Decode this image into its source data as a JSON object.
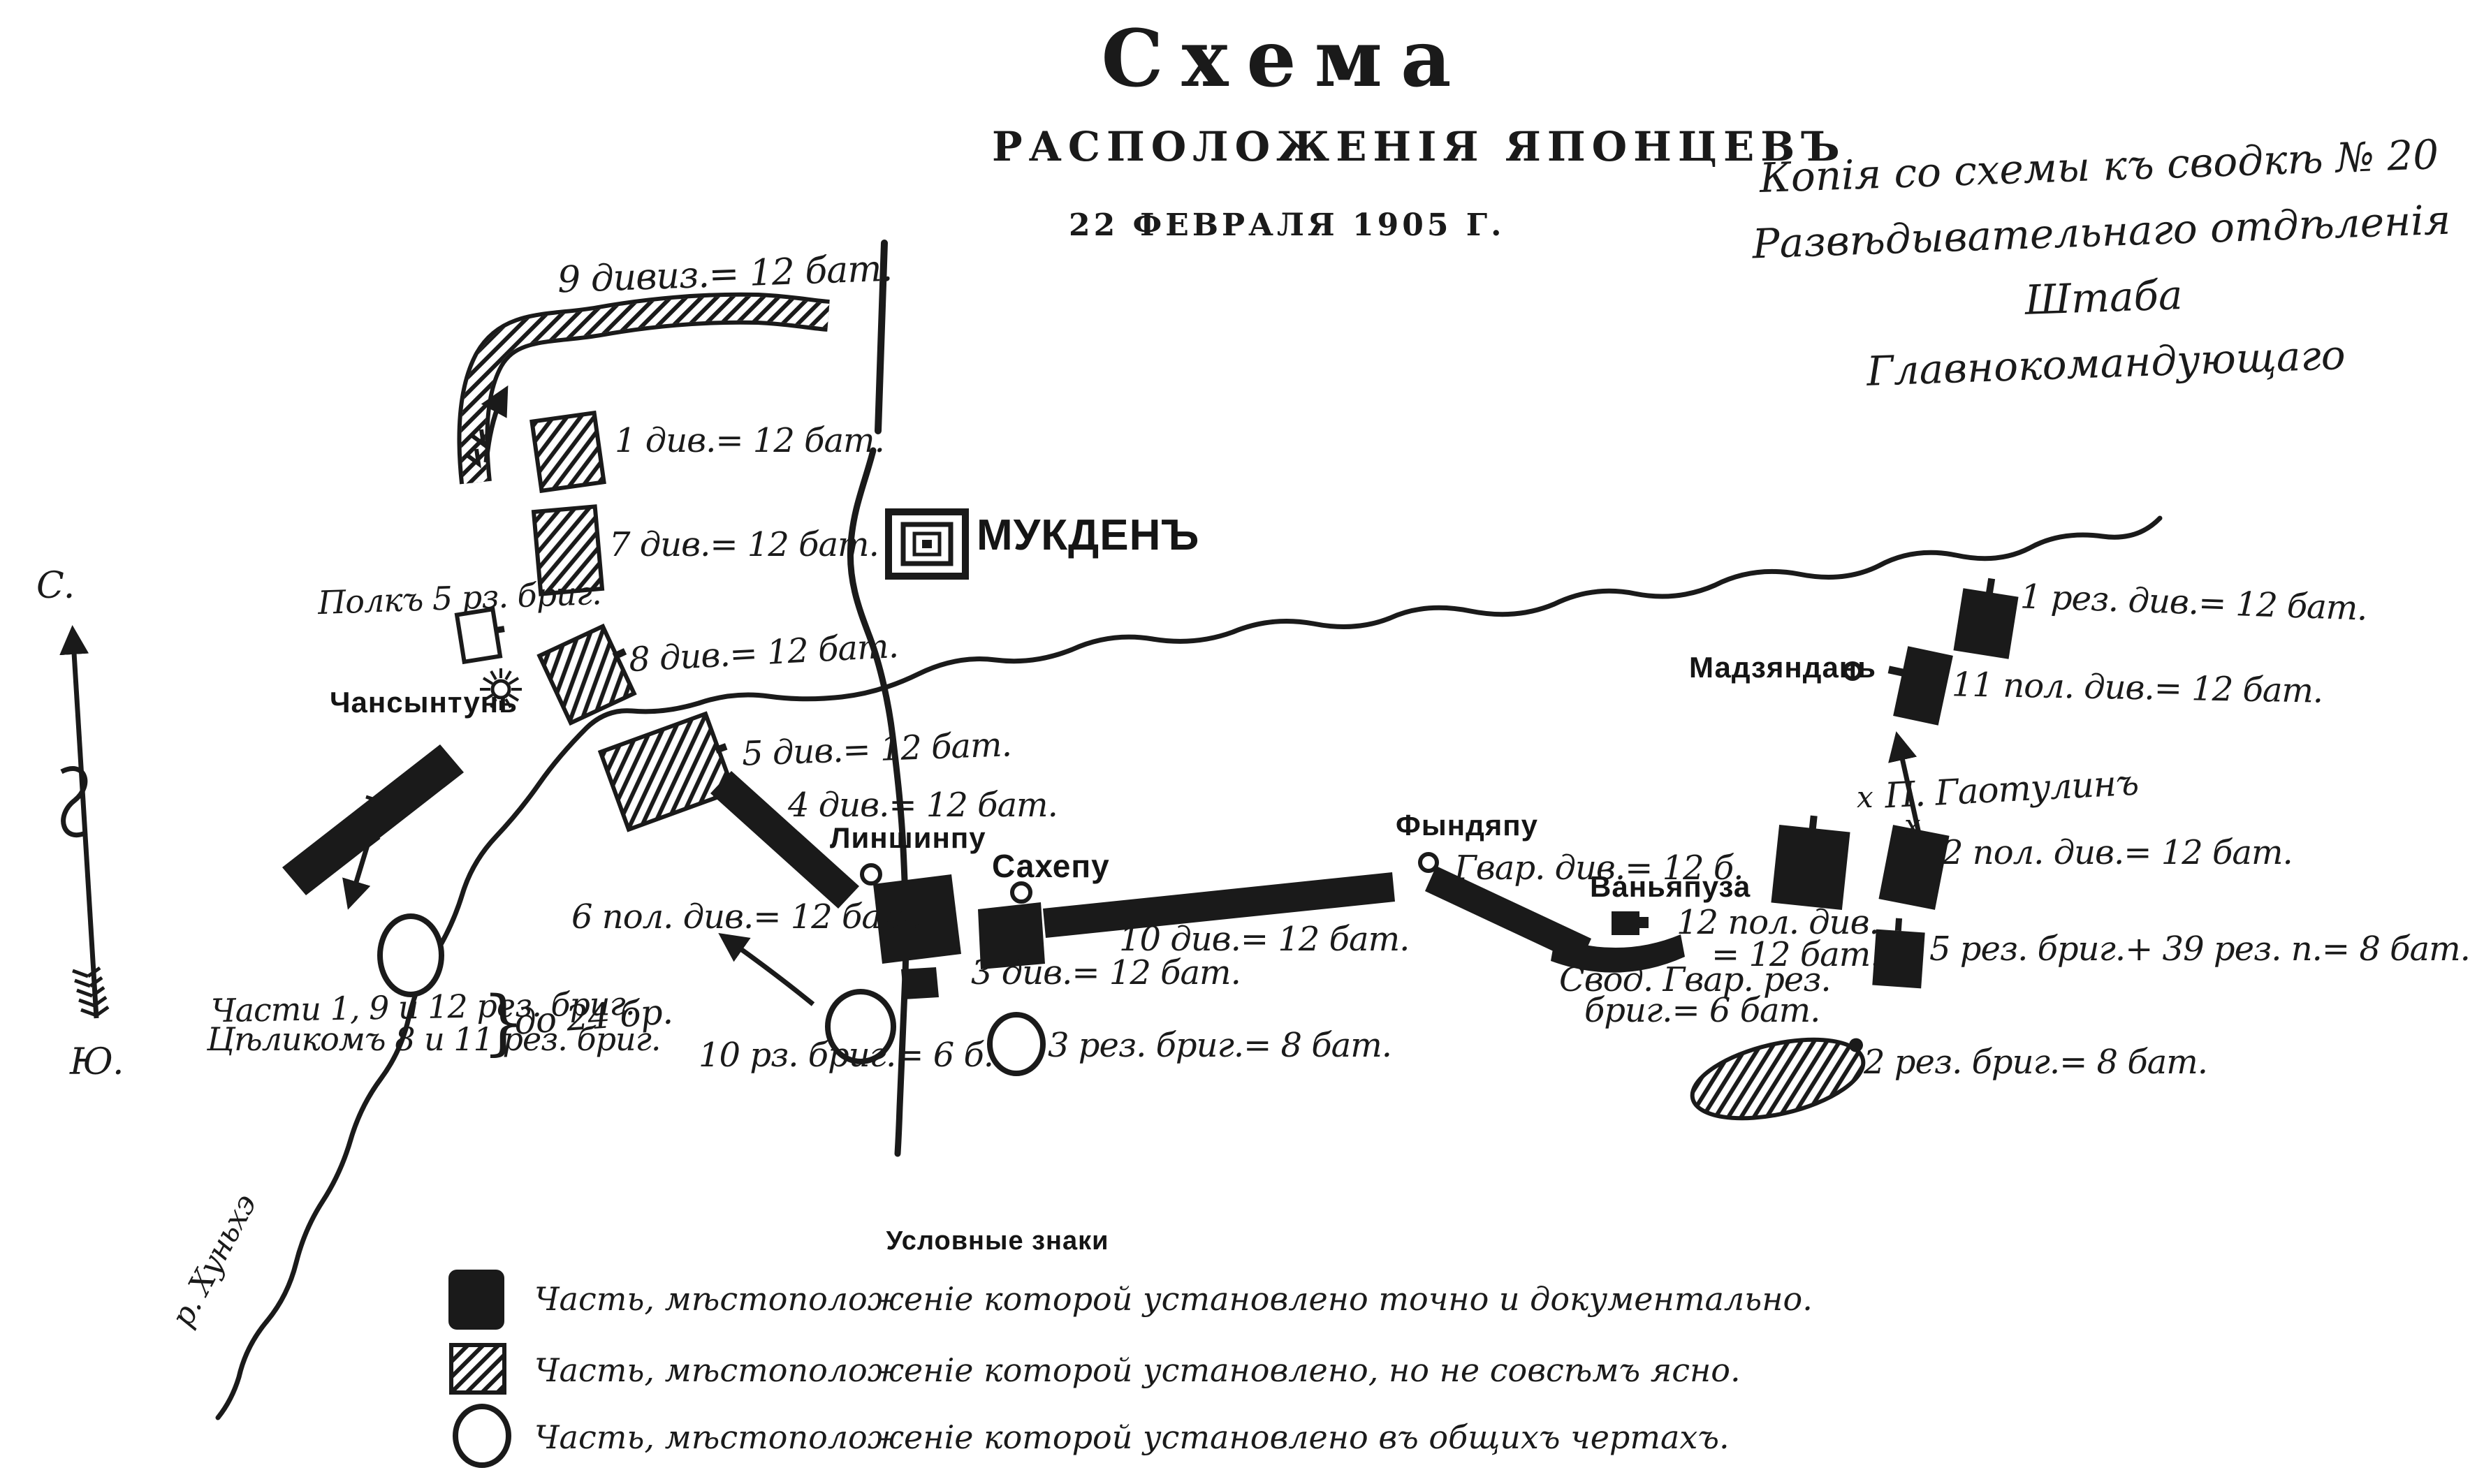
{
  "title": {
    "main": "Схема",
    "sub": "РАСПОЛОЖЕНІЯ ЯПОНЦЕВЪ",
    "date": "22 ФЕВРАЛЯ 1905 Г."
  },
  "note": {
    "line1": "Копія со схемы къ сводкѣ № 20",
    "line2": "Развѣдывательнаго отдѣленія Штаба",
    "line3": "Главнокомандующаго"
  },
  "compass": {
    "north": "С.",
    "south": "Ю."
  },
  "towns": {
    "mukden": "МУКДЕНЪ",
    "chansyntun": "Чансынтунь",
    "linshinpu": "Линшинпу",
    "sahepu": "Сахепу",
    "fyndyapu": "Фындяпу",
    "vanyapuza": "Ваньяпуза",
    "madzyandan": "Мадзяндань",
    "gaotulin": "П. Гаотулинъ",
    "gaotulin_mark": "х",
    "river": "р. Хуньхэ"
  },
  "units": {
    "div9": "9 дивиз.= 12 бат.",
    "div1": "1 див.= 12 бат.",
    "div7": "7 див.= 12 бат.",
    "polk5": "Полкъ 5 рз. бриг.",
    "div8": "8 див.= 12 бат.",
    "div5": "5 див.= 12 бат.",
    "div4": "4 див.= 12 бат.",
    "pol6": "6 пол. див.= 12 бат.",
    "div3": "3 див.= 12 бат.",
    "div10": "10 див.= 12 бат.",
    "gvar": "Гвар. див.= 12 б.",
    "chasti_line1": "Части 1, 9 и 12 рез. бриг.",
    "chasti_line2": "Цѣликомъ 8 и 11 рез. бриг.",
    "brace": "}",
    "do24": "до 24 бр.",
    "rz10": "10 рз. бриг.= 6 б.",
    "rez3": "3 рез. бриг.= 8 бат.",
    "svod_line1": "Свод. Гвар. рез.",
    "svod_line2": "бриг.= 6 бат.",
    "pol12_line1": "12 пол. див.",
    "pol12_line2": "= 12 бат.",
    "pol2": "2 пол. див.= 12 бат.",
    "rez1": "1 рез. див.= 12 бат.",
    "pol11": "11 пол. див.= 12 бат.",
    "rez5": "5 рез. бриг.+ 39 рез. п.= 8 бат.",
    "rez2": "2 рез. бриг.= 8 бат."
  },
  "legend": {
    "header": "Условные знаки",
    "items": [
      {
        "symbol": "solid-square",
        "text": "Часть, мѣстоположеніе которой установлено точно и документально."
      },
      {
        "symbol": "hatched-square",
        "text": "Часть, мѣстоположеніе которой установлено, но не совсѣмъ ясно."
      },
      {
        "symbol": "circle",
        "text": "Часть, мѣстоположеніе которой установлено въ общихъ чертахъ."
      }
    ]
  },
  "colors": {
    "ink": "#1a1a1a",
    "paper": "#ffffff"
  }
}
